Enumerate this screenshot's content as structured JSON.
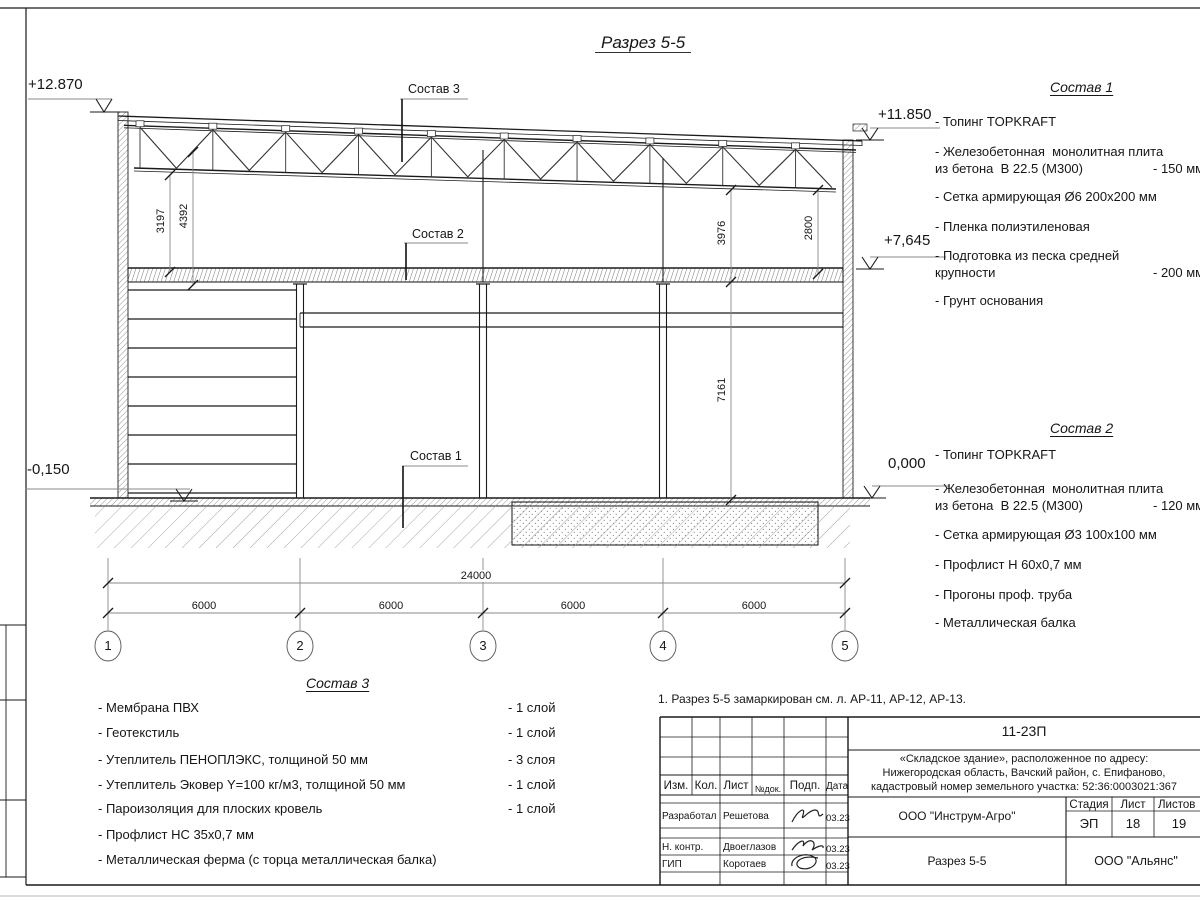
{
  "drawing": {
    "title": "Разрез 5-5"
  },
  "elevations": {
    "top_left": "+12.870",
    "bottom_left": "-0,150",
    "top_right": "+11.850",
    "mid_right": "+7,645",
    "zero_right": "0,000"
  },
  "axis_labels": [
    "1",
    "2",
    "3",
    "4",
    "5"
  ],
  "dimensions": {
    "total": "24000",
    "bays": [
      "6000",
      "6000",
      "6000",
      "6000"
    ],
    "v_3197": "3197",
    "v_4392": "4392",
    "v_3976": "3976",
    "v_2800": "2800",
    "v_7161": "7161"
  },
  "callouts": {
    "sostav1": "Состав 1",
    "sostav2": "Состав 2",
    "sostav3": "Состав 3"
  },
  "sostav1": {
    "title": "Состав 1",
    "items": [
      {
        "line1": "- Топинг TOPKRAFT",
        "line2": "",
        "value": ""
      },
      {
        "line1": "- Железобетонная  монолитная плита",
        "line2": "из бетона  В 22.5 (М300)",
        "value": "- 150 мм"
      },
      {
        "line1": "- Сетка армирующая Ø6 200x200 мм",
        "line2": "",
        "value": ""
      },
      {
        "line1": "- Пленка полиэтиленовая",
        "line2": "",
        "value": ""
      },
      {
        "line1": "- Подготовка из песка средней",
        "line2": "крупности",
        "value": "- 200 мм"
      },
      {
        "line1": "- Грунт основания",
        "line2": "",
        "value": ""
      }
    ]
  },
  "sostav2": {
    "title": "Состав 2",
    "items": [
      {
        "line1": "- Топинг TOPKRAFT",
        "line2": "",
        "value": ""
      },
      {
        "line1": "- Железобетонная  монолитная плита",
        "line2": "из бетона  В 22.5 (М300)",
        "value": "- 120 мм"
      },
      {
        "line1": "- Сетка армирующая Ø3 100x100 мм",
        "line2": "",
        "value": ""
      },
      {
        "line1": "- Профлист Н 60x0,7 мм",
        "line2": "",
        "value": ""
      },
      {
        "line1": "- Прогоны проф. труба",
        "line2": "",
        "value": ""
      },
      {
        "line1": "- Металлическая балка",
        "line2": "",
        "value": ""
      }
    ]
  },
  "sostav3": {
    "title": "Состав 3",
    "items": [
      {
        "text": "- Мембрана ПВХ",
        "value": "- 1 слой"
      },
      {
        "text": "- Геотекстиль",
        "value": "- 1 слой"
      },
      {
        "text": "- Утеплитель ПЕНОПЛЭКС, толщиной 50 мм",
        "value": "- 3 слоя"
      },
      {
        "text": "- Утеплитель Эковер Y=100 кг/м3, толщиной 50 мм",
        "value": "- 1 слой"
      },
      {
        "text": "- Пароизоляция для плоских кровель",
        "value": "- 1 слой"
      },
      {
        "text": "- Профлист НС 35x0,7 мм",
        "value": ""
      },
      {
        "text": "- Металлическая ферма (с торца металлическая балка)",
        "value": ""
      }
    ]
  },
  "titleblock": {
    "note": "1. Разрез 5-5 замаркирован см. л. АР-11, АР-12, АР-13.",
    "doc_number": "11-23П",
    "address_line1": "«Складское здание», расположенное по адресу:",
    "address_line2": "Нижегородская область, Вачский район, с. Епифаново,",
    "address_line3": "кадастровый номер земельного участка: 52:36:0003021:367",
    "columns": {
      "izm": "Изм.",
      "kol": "Кол.",
      "list": "Лист",
      "ndok": "№док.",
      "podp": "Подп.",
      "data": "Дата"
    },
    "rows": [
      {
        "role": "Разработал",
        "name": "Решетова",
        "date": "03.23"
      },
      {
        "role": "Н. контр.",
        "name": "Двоеглазов",
        "date": "03.23"
      },
      {
        "role": "ГИП",
        "name": "Коротаев",
        "date": "03.23"
      }
    ],
    "company": "ООО \"Инструм-Агро\"",
    "stage_label": "Стадия",
    "sheet_label": "Лист",
    "sheets_label": "Листов",
    "stage": "ЭП",
    "sheet": "18",
    "sheets": "19",
    "drawing_name": "Разрез 5-5",
    "contractor": "ООО \"Альянс\""
  }
}
